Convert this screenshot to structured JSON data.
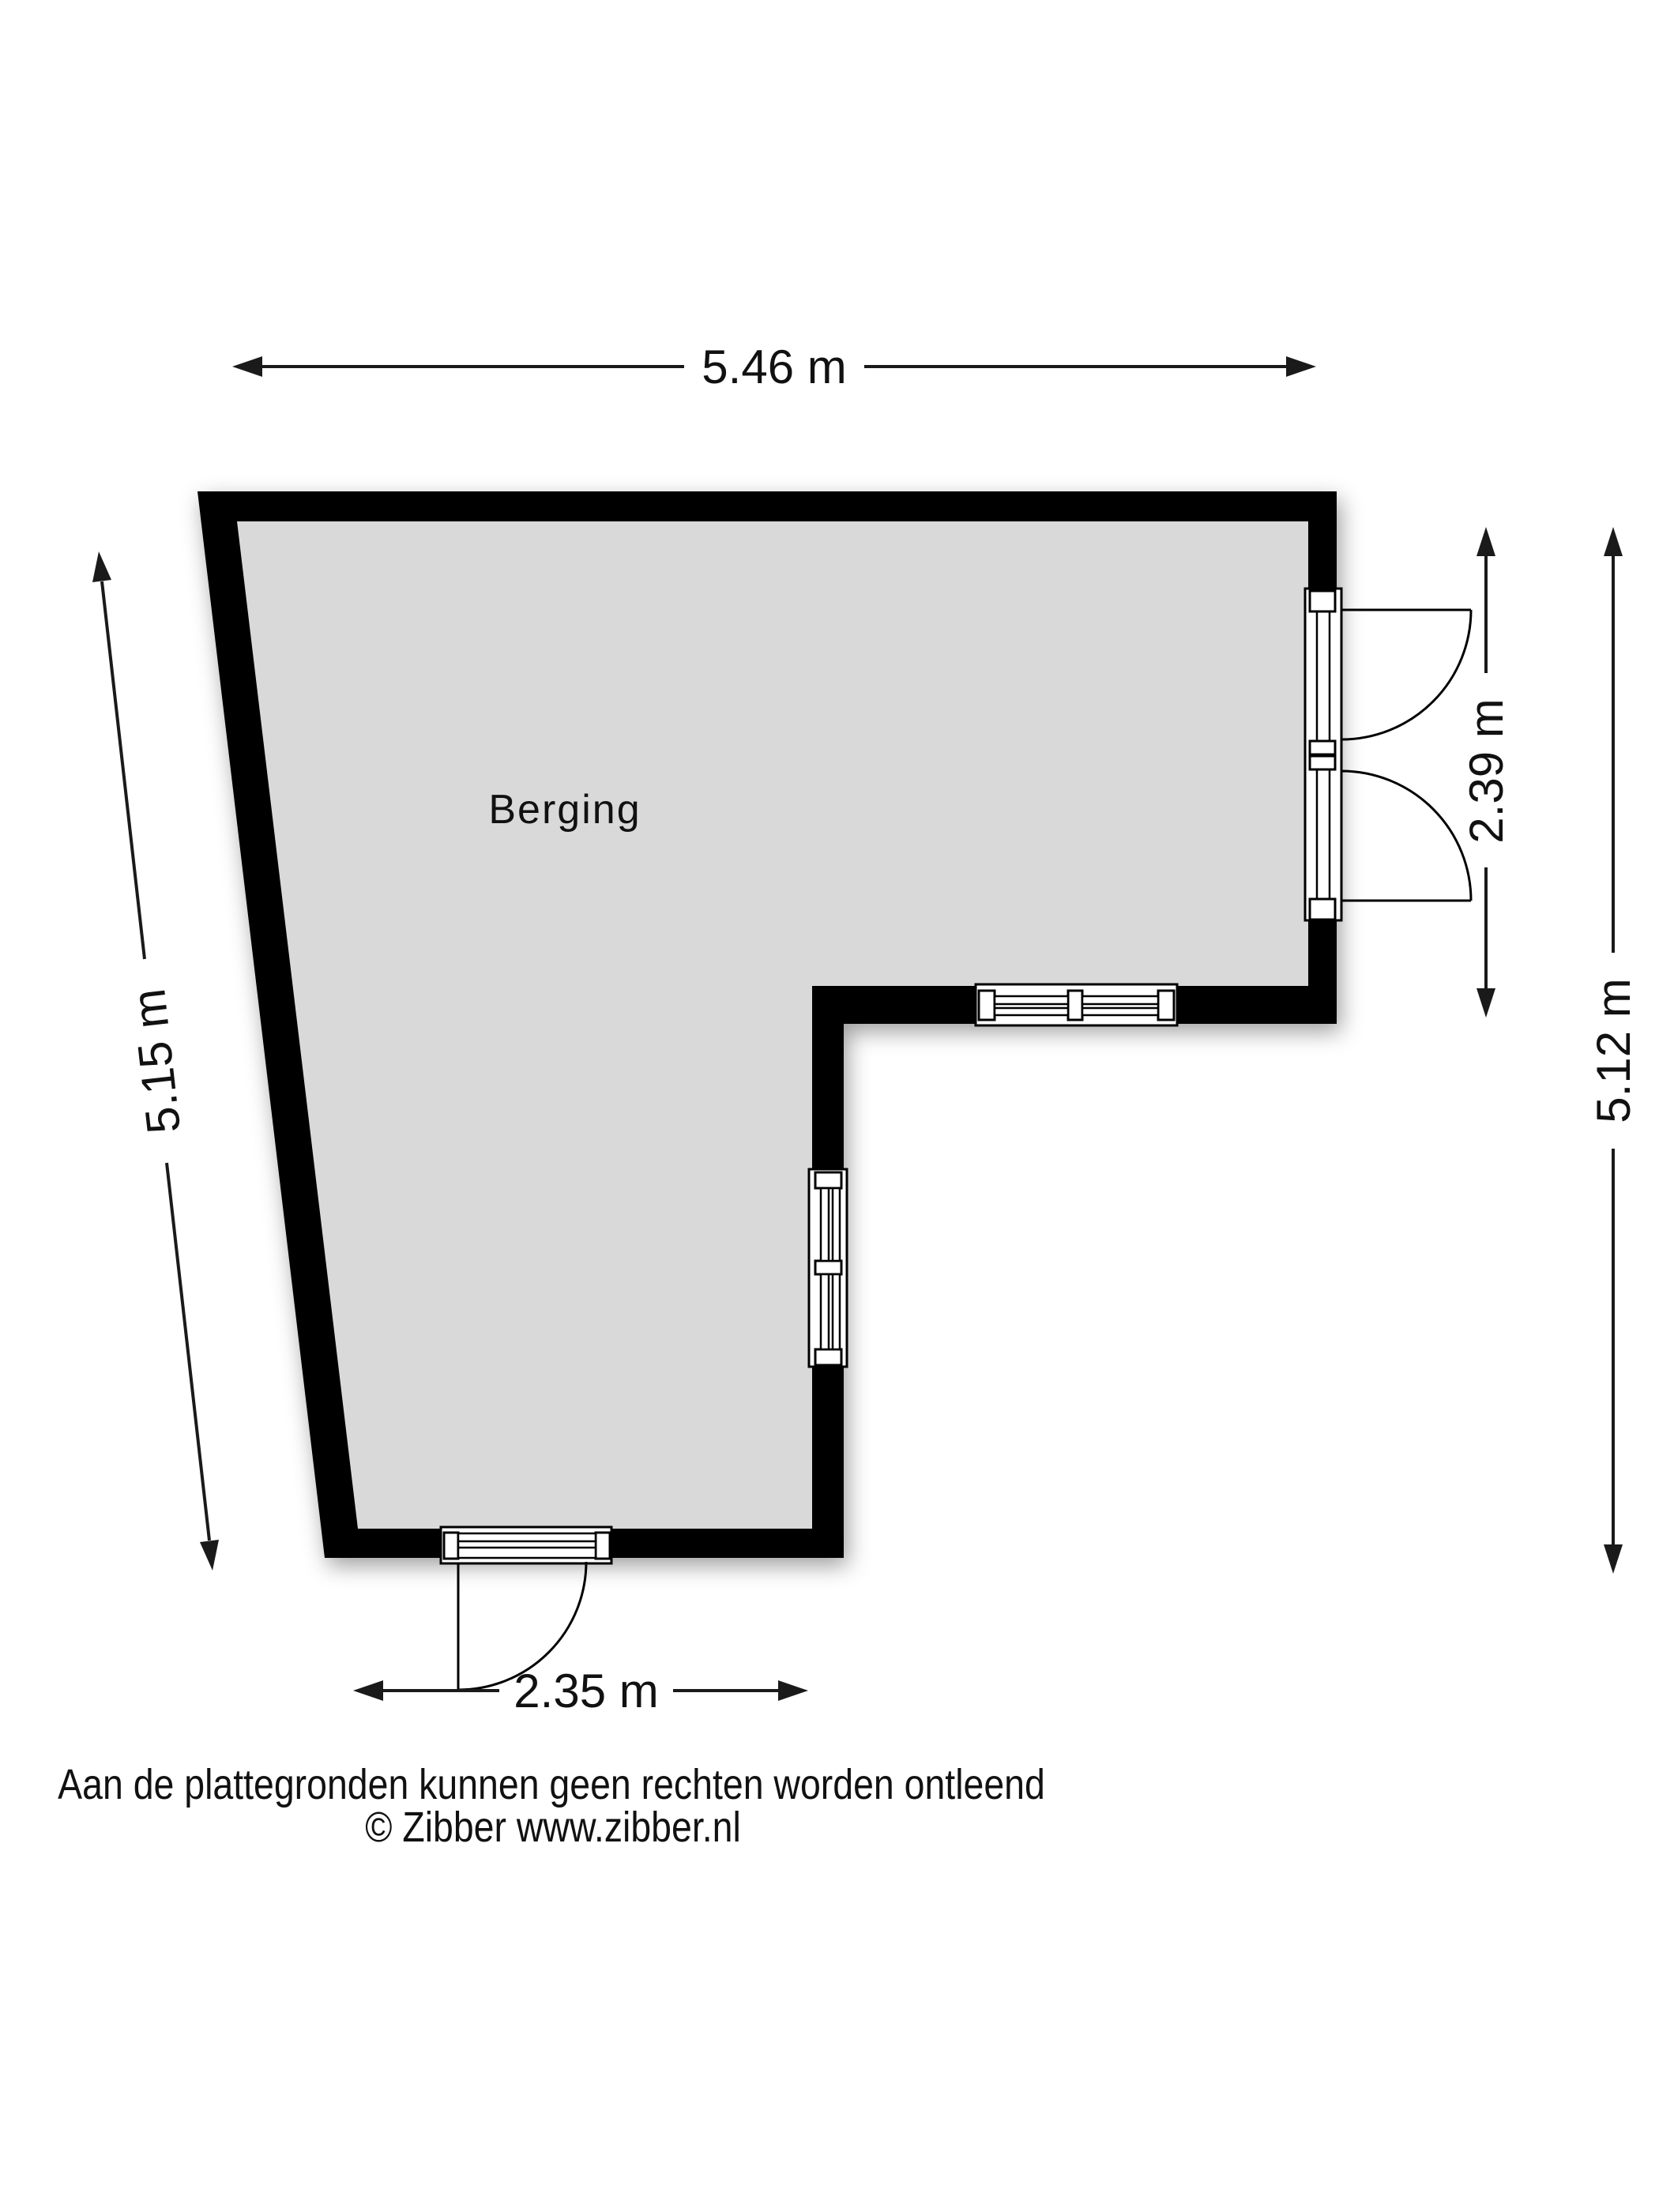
{
  "floorplan": {
    "room_label": "Berging",
    "dimensions": {
      "top": "5.46 m",
      "left": "5.15 m",
      "right_inner": "2.39 m",
      "right_outer": "5.12 m",
      "bottom": "2.35 m"
    },
    "footer": {
      "disclaimer": "Aan de plattegronden kunnen geen rechten worden ontleend",
      "copyright": "© Zibber www.zibber.nl"
    },
    "colors": {
      "wall": "#000000",
      "floor": "#d9d9d9",
      "background": "#ffffff",
      "text": "#1a1a1a"
    }
  }
}
